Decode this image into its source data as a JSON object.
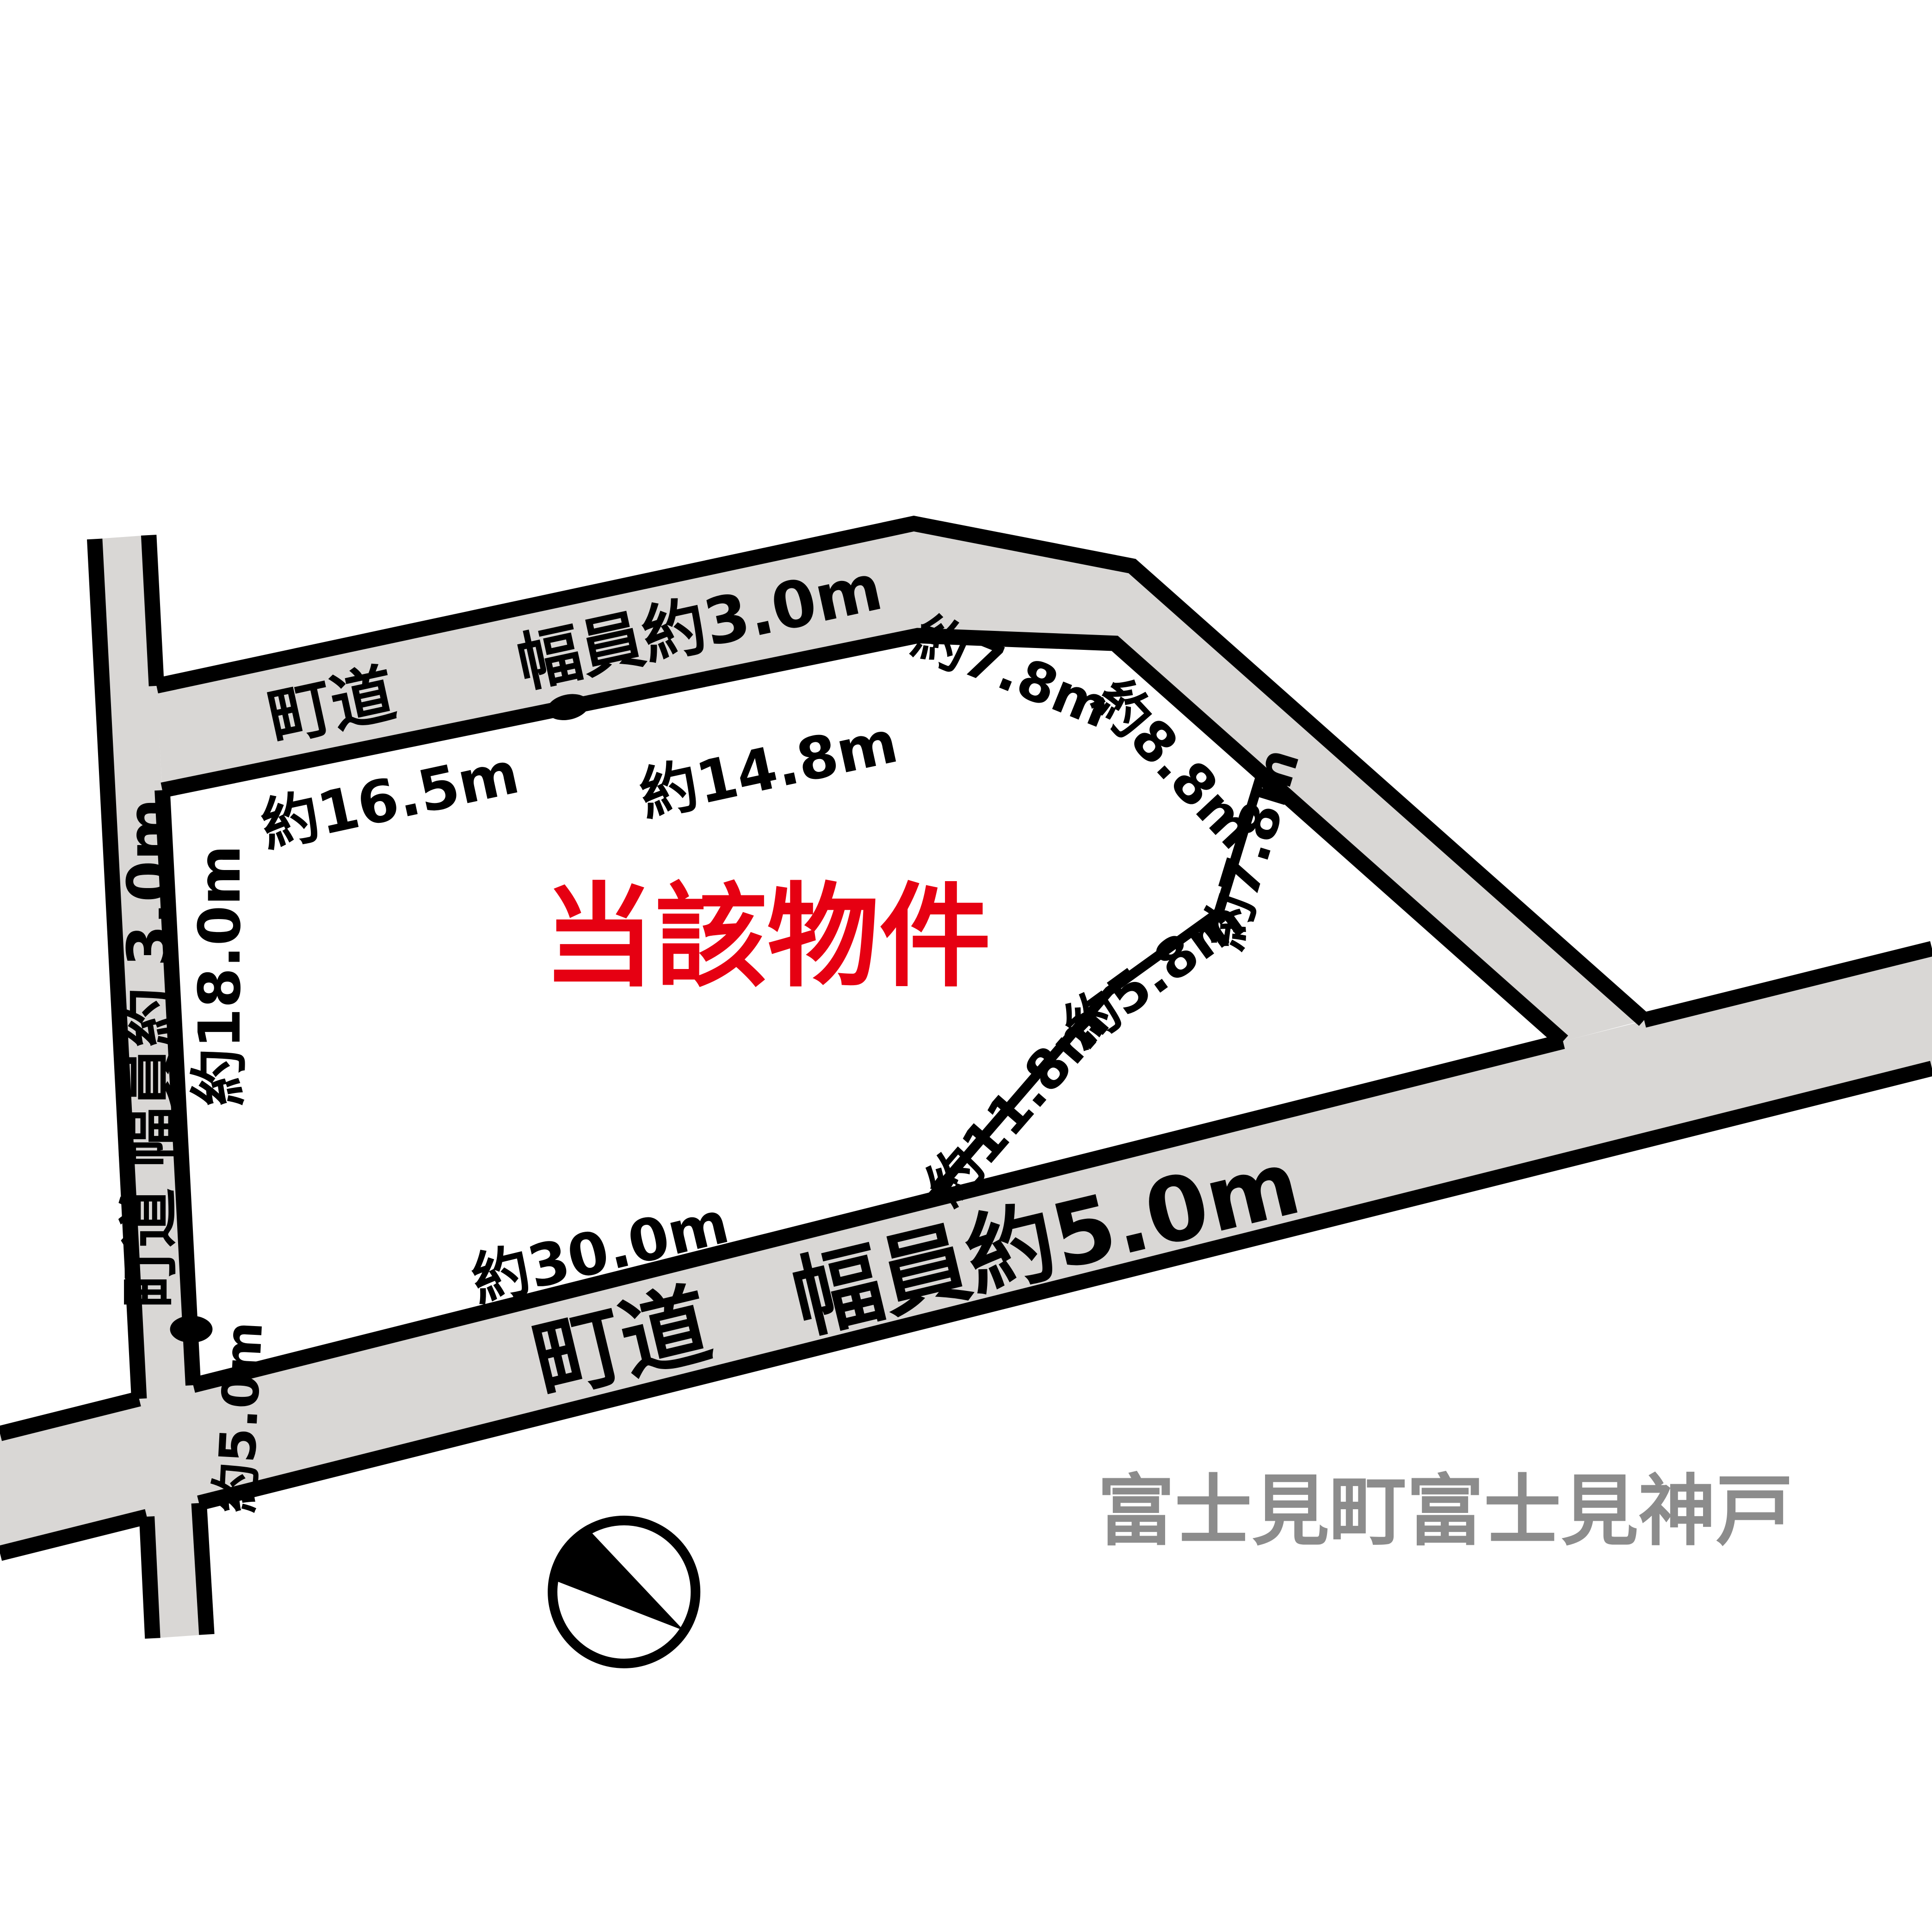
{
  "colors": {
    "road_fill": "#d9d7d5",
    "outline": "#000000",
    "property_red": "#e60012",
    "area_gray": "#8c8c8c"
  },
  "labels": {
    "road_top": {
      "text": "町道　　幅員約3.0m"
    },
    "road_left": {
      "text": "町道 幅員約 3.0m"
    },
    "road_bottom": {
      "text": "町道　幅員約5.0m"
    },
    "dim_top_left": {
      "text": "約16.5m"
    },
    "dim_top_right": {
      "text": "約14.8m"
    },
    "dim_ne_1": {
      "text": "約7.8m"
    },
    "dim_ne_2": {
      "text": "約8.8m"
    },
    "dim_east_1": {
      "text": "約7.8m"
    },
    "dim_east_2": {
      "text": "約5.8m"
    },
    "dim_east_3": {
      "text": "約11.8m"
    },
    "dim_south": {
      "text": "約30.0m"
    },
    "dim_west": {
      "text": "約18.0m"
    },
    "dim_west_2": {
      "text": "約5.0m"
    },
    "property": {
      "text": "当該物件"
    },
    "area_name": {
      "text": "富士見町富士見神戸"
    }
  }
}
